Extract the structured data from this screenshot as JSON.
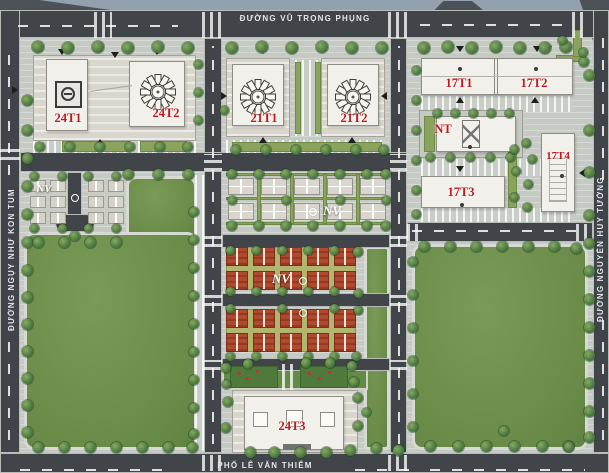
{
  "map_title": "residential quarter site plan",
  "streets": {
    "top": {
      "name": "ĐƯỜNG VŨ TRỌNG PHỤNG"
    },
    "bottom": {
      "name": "PHỐ LÊ VĂN THIÊM"
    },
    "left": {
      "name": "ĐƯỜNG NGỤY NHƯ KON TUM"
    },
    "right": {
      "name": "ĐƯỜNG NGUYỄN HUY TƯỞNG"
    }
  },
  "labels": {
    "b24t1": "24T1",
    "b24t2": "24T2",
    "b21t1": "21T1",
    "b21t2": "21T2",
    "b17t1": "17T1",
    "b17t2": "17T2",
    "b17t3": "17T3",
    "b17t4": "17T4",
    "nt": "NT",
    "b24t3": "24T3",
    "nv_left": "NV",
    "nv_villas": "NV",
    "nv_rowhouses": "NV"
  },
  "palette": {
    "tower_label_red": "#c4161c",
    "nv_label_white": "#ffffff",
    "lawn_green": "#6b8c49",
    "road_gray": "#41454a",
    "tree_green": "#4d7a41",
    "rowhouse_red": "#b04a2e",
    "building_white": "#f2f0ea",
    "street_text": "#e3e7ea"
  }
}
